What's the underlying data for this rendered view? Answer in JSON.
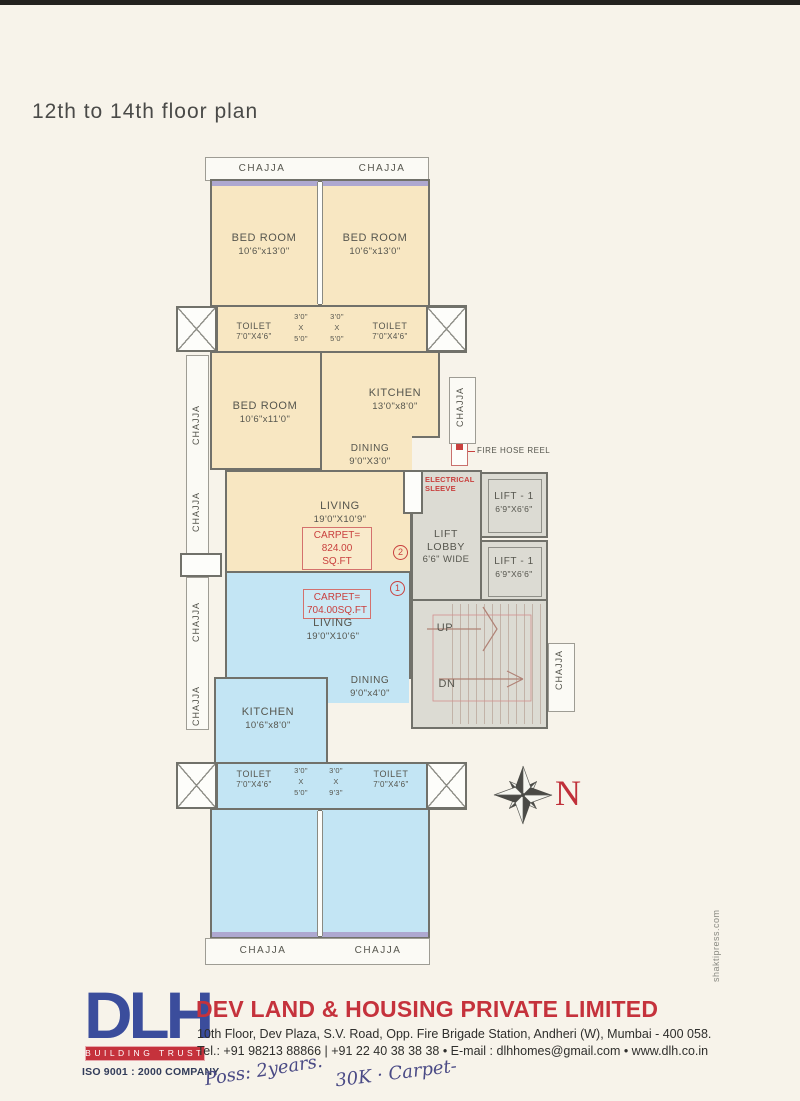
{
  "page": {
    "title": "12th to 14th floor plan",
    "watermark": "shaktipress.com",
    "compass_label": "N"
  },
  "colors": {
    "upper_flat": "#f8e7c2",
    "lower_flat": "#c3e5f4",
    "common_area": "#dcdbd3",
    "annotation_red": "#c9403e",
    "brand_red": "#c5323c",
    "brand_blue": "#3b4d9c"
  },
  "plan": {
    "chajja": "CHAJJA",
    "rooms": {
      "bed_t1": {
        "name": "BED ROOM",
        "dims": "10'6\"x13'0\""
      },
      "bed_t2": {
        "name": "BED ROOM",
        "dims": "10'6\"x13'0\""
      },
      "toilet_t1": {
        "name": "TOILET",
        "dims": "7'0\"X4'6\""
      },
      "toilet_t2": {
        "name": "TOILET",
        "dims": "7'0\"X4'6\""
      },
      "pass_t1": {
        "l1": "3'0\"",
        "l2": "X",
        "l3": "5'0\""
      },
      "pass_t2": {
        "l1": "3'0\"",
        "l2": "X",
        "l3": "5'0\""
      },
      "bed_t3": {
        "name": "BED ROOM",
        "dims": "10'6\"x11'0\""
      },
      "kitchen_t": {
        "name": "KITCHEN",
        "dims": "13'0\"x8'0\""
      },
      "dining_t": {
        "name": "DINING",
        "dims": "9'0\"X3'0\""
      },
      "living_t": {
        "name": "LIVING",
        "dims": "19'0\"X10'9\""
      },
      "carpet_t": {
        "l1": "CARPET=",
        "l2": "824.00 SQ.FT"
      },
      "unit_2": "2",
      "electrical": {
        "l1": "ELECTRICAL",
        "l2": "SLEEVE"
      },
      "fire_hose": "FIRE HOSE REEL",
      "lift_lobby": {
        "l1": "LIFT",
        "l2": "LOBBY",
        "l3": "6'6\" WIDE"
      },
      "lift_1": {
        "name": "LIFT - 1",
        "dims": "6'9\"X6'6\""
      },
      "lift_2": {
        "name": "LIFT - 1",
        "dims": "6'9\"X6'6\""
      },
      "stairs_up": "UP",
      "stairs_dn": "DN",
      "unit_1": "1",
      "carpet_b": {
        "l1": "CARPET=",
        "l2": "704.00SQ.FT"
      },
      "living_b": {
        "name": "LIVING",
        "dims": "19'0\"X10'6\""
      },
      "dining_b": {
        "name": "DINING",
        "dims": "9'0\"x4'0\""
      },
      "kitchen_b": {
        "name": "KITCHEN",
        "dims": "10'6\"x8'0\""
      },
      "toilet_b1": {
        "name": "TOILET",
        "dims": "7'0\"X4'6\""
      },
      "toilet_b2": {
        "name": "TOILET",
        "dims": "7'0\"X4'6\""
      },
      "pass_b1": {
        "l1": "3'0\"",
        "l2": "X",
        "l3": "5'0\""
      },
      "pass_b2": {
        "l1": "3'0\"",
        "l2": "X",
        "l3": "9'3\""
      }
    }
  },
  "footer": {
    "logo_text": "DLH",
    "logo_tagline": "BUILDING TRUST",
    "logo_iso": "ISO 9001 : 2000 COMPANY",
    "company_name": "DEV LAND & HOUSING PRIVATE LIMITED",
    "address": "10th Floor, Dev Plaza, S.V. Road, Opp. Fire Brigade Station, Andheri (W), Mumbai - 400 058.",
    "contact": "Tel.: +91 98213 88866 | +91 22 40 38 38 38  •  E-mail : dlhhomes@gmail.com  •  www.dlh.co.in",
    "handwriting_1": "Poss: 2years.",
    "handwriting_2": "30K · Carpet-"
  }
}
